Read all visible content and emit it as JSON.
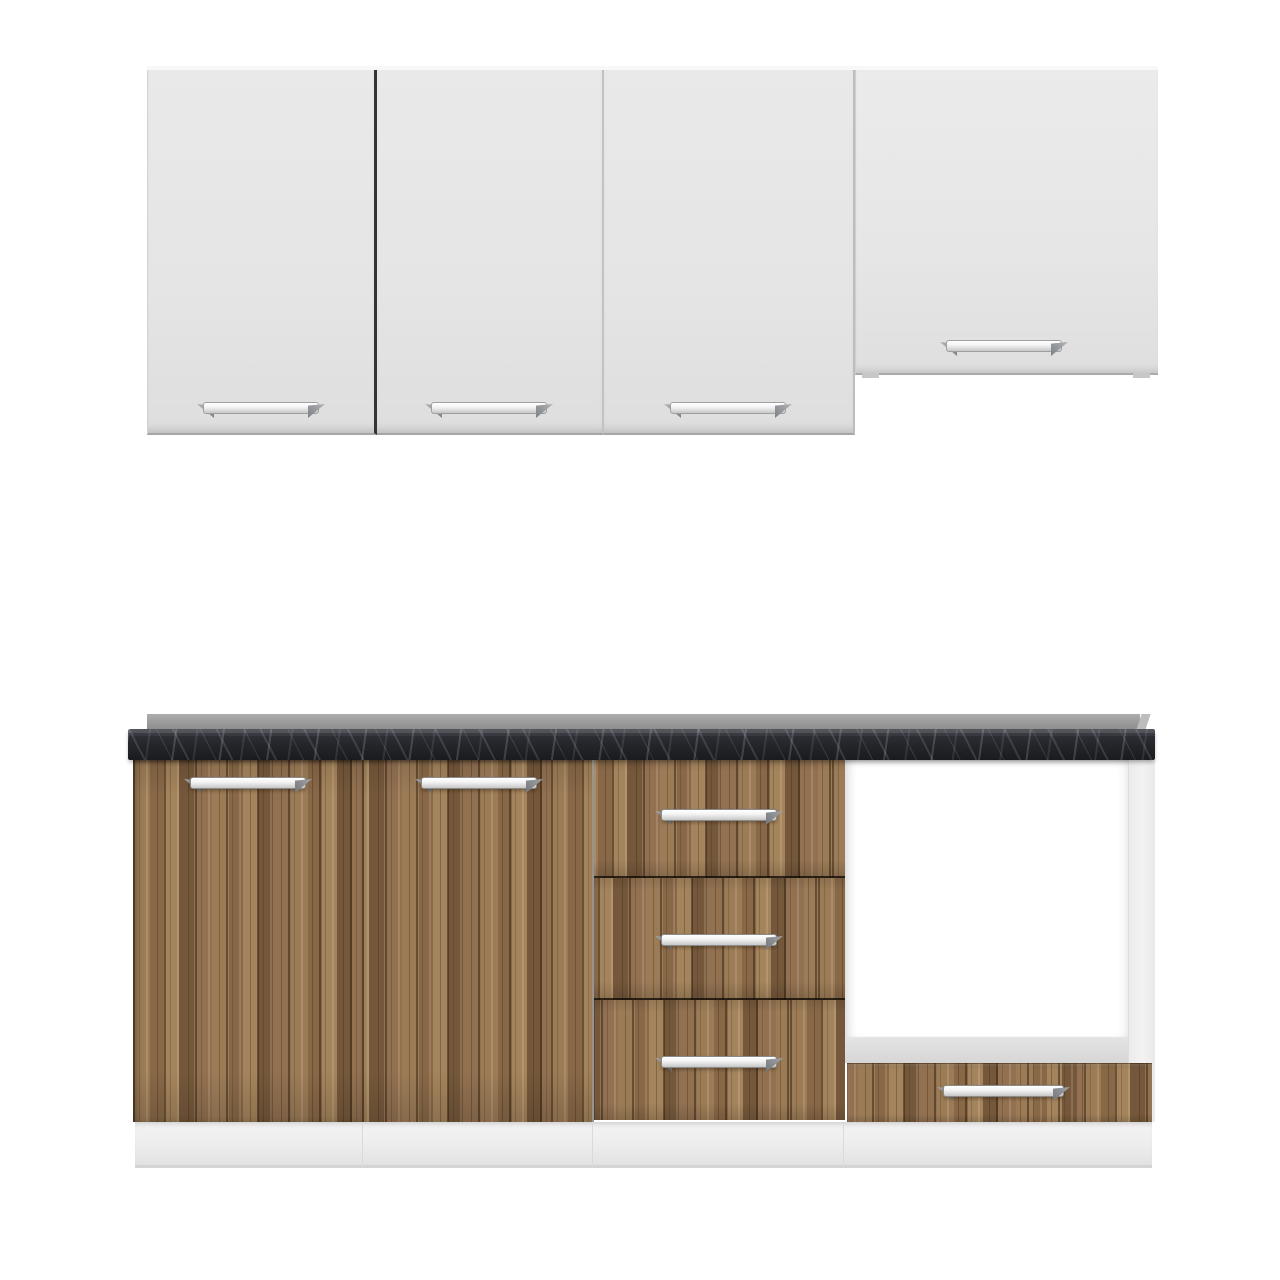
{
  "scene_label": "Modular kitchen cabinet set: white wall cabinets, walnut-wood base unit with dark marble countertop and open oven compartment",
  "structure": {
    "wall_cabinets": {
      "tall_doors": 3,
      "short_doors": 1,
      "handles": 4
    },
    "base_unit": {
      "doors": 2,
      "stack_drawers": 3,
      "oven_compartments": 1,
      "oven_drawers": 1,
      "handles": 6
    }
  },
  "colors": {
    "bg": "#ffffff",
    "cabinet-light": "#e9e9e9",
    "cabinet-light-deep": "#dedede",
    "divider-dark": "#343434",
    "divider-light": "#c2c2c2",
    "wood-base": "#8b6c4a",
    "wood-light": "#a4845c",
    "wood-dark": "#75583b",
    "counter-top": "#32353c",
    "counter-deep": "#191b1f",
    "backsplash": "#9a9a9a",
    "cavity-white": "#ffffff",
    "cavity-floor": "#d6d6d6",
    "panel-white": "#f2f2f2",
    "plinth": "#ededed",
    "handle-bar": "#f4f4f4",
    "handle-cap": "#7d8084"
  }
}
